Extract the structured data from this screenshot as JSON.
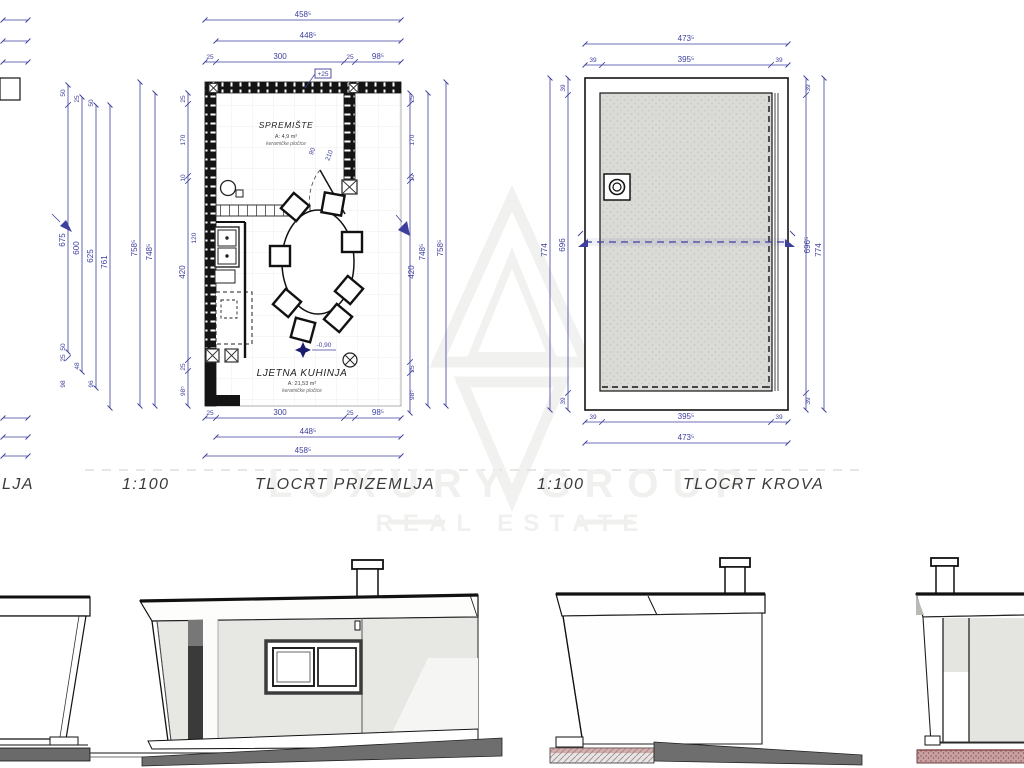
{
  "labels": {
    "partial": "LJA",
    "scale1": "1:100",
    "plan1": "TLOCRT PRIZEMLJA",
    "scale2": "1:100",
    "plan2": "TLOCRT KROVA"
  },
  "watermark": {
    "line1": "LUXURY GROUP",
    "line2": "REAL ESTATE"
  },
  "fp": {
    "rooms": {
      "storage": {
        "name": "SPREMIŠTE",
        "area": "A: 4,9 m²",
        "mat": "keramičke pločice"
      },
      "kitchen": {
        "name": "LJETNA KUHINJA",
        "area": "A: 21,53 m²",
        "mat": "keramičke pločice"
      }
    },
    "marks": {
      "level": "-0,90",
      "door_h": "210",
      "door_w": "90",
      "note": "+25",
      "counter": "120"
    },
    "d": {
      "t": [
        "458⁵",
        "448⁵"
      ],
      "tc": [
        "25",
        "300",
        "25",
        "98⁵"
      ],
      "bc": [
        "25",
        "300",
        "25",
        "98⁵"
      ],
      "b": [
        "448⁵",
        "458⁵"
      ],
      "lo": [
        "675",
        "600",
        "625",
        "761"
      ],
      "lot": [
        "50",
        "25",
        "50"
      ],
      "lob": [
        "50",
        "25",
        "48",
        "98",
        "96"
      ],
      "ll": [
        "758⁵",
        "748⁵"
      ],
      "lc": [
        "25",
        "170",
        "10",
        "420",
        "25",
        "98⁵"
      ],
      "rc": [
        "25",
        "170",
        "10",
        "420",
        "25",
        "98⁵"
      ],
      "rl": [
        "748⁵",
        "758⁵"
      ]
    }
  },
  "rp": {
    "d": {
      "t": "473⁵",
      "tc": [
        "39",
        "395⁵",
        "39"
      ],
      "bc": [
        "39",
        "395⁵",
        "39"
      ],
      "b": "473⁵",
      "lc": [
        "39",
        "696",
        "39"
      ],
      "lo": "774",
      "rc": [
        "39",
        "696⁵",
        "39"
      ],
      "ro": "774"
    }
  },
  "colors": {
    "dimension_blue": "#3d3f9e",
    "line_black": "#1a1a1a",
    "roof_fill": "#d9d9d6",
    "facade_gray": "#e7e7e4",
    "ground_dark": "#6e6e6e",
    "earth_red": "#b98e8e"
  }
}
